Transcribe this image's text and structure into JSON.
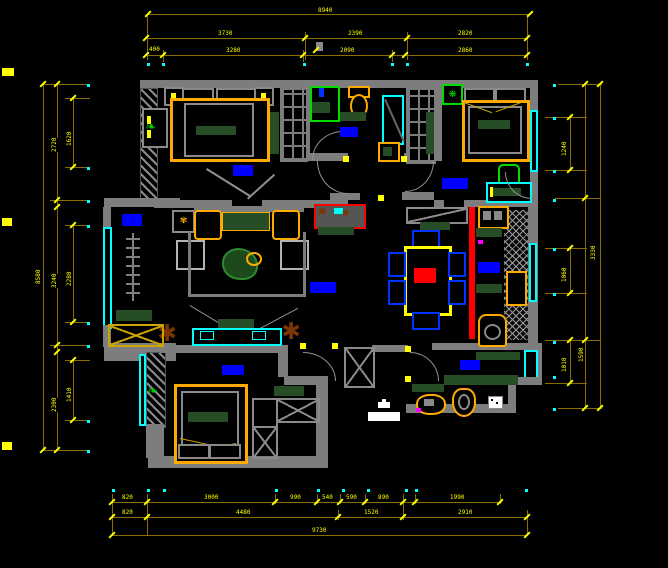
{
  "app": {
    "type": "cad-floor-plan-screenshot",
    "background": "#000000"
  },
  "palette": {
    "wall": "#7d7d7d",
    "dimension_line": "#8a6d00",
    "dimension_text": "#ffff00",
    "window": "#00ffff",
    "room_label_block": "#0000ff",
    "furniture_frame": "#ffaa00",
    "counter_green": "#264d26",
    "fixture_green": "#00dd00",
    "feature_red": "#ff0000",
    "plant_brown": "#7b3503",
    "chair_blue": "#0033ff",
    "white": "#ffffff"
  },
  "dimensions": {
    "lines": [
      {
        "x": 148,
        "y": 14,
        "len": 382,
        "o": "h"
      },
      {
        "x": 146,
        "y": 38,
        "len": 381,
        "o": "h"
      },
      {
        "x": 146,
        "y": 55,
        "len": 381,
        "o": "h"
      },
      {
        "x": 147,
        "y": 14,
        "len": 46,
        "o": "v"
      },
      {
        "x": 527,
        "y": 14,
        "len": 46,
        "o": "v"
      },
      {
        "x": 305,
        "y": 32,
        "len": 28,
        "o": "v"
      },
      {
        "x": 407,
        "y": 32,
        "len": 28,
        "o": "v"
      },
      {
        "x": 163,
        "y": 50,
        "len": 12,
        "o": "v"
      },
      {
        "x": 303,
        "y": 50,
        "len": 12,
        "o": "v"
      },
      {
        "x": 392,
        "y": 50,
        "len": 12,
        "o": "v"
      },
      {
        "x": 112,
        "y": 502,
        "len": 390,
        "o": "h"
      },
      {
        "x": 112,
        "y": 517,
        "len": 415,
        "o": "h"
      },
      {
        "x": 112,
        "y": 535,
        "len": 415,
        "o": "h"
      },
      {
        "x": 112,
        "y": 494,
        "len": 42,
        "o": "v"
      },
      {
        "x": 147,
        "y": 494,
        "len": 42,
        "o": "v"
      },
      {
        "x": 275,
        "y": 494,
        "len": 10,
        "o": "v"
      },
      {
        "x": 317,
        "y": 494,
        "len": 10,
        "o": "v"
      },
      {
        "x": 340,
        "y": 494,
        "len": 10,
        "o": "v"
      },
      {
        "x": 365,
        "y": 494,
        "len": 10,
        "o": "v"
      },
      {
        "x": 403,
        "y": 494,
        "len": 26,
        "o": "v"
      },
      {
        "x": 415,
        "y": 494,
        "len": 10,
        "o": "v"
      },
      {
        "x": 500,
        "y": 494,
        "len": 10,
        "o": "v"
      },
      {
        "x": 527,
        "y": 510,
        "len": 26,
        "o": "v"
      },
      {
        "x": 338,
        "y": 510,
        "len": 10,
        "o": "v"
      },
      {
        "x": 43,
        "y": 84,
        "len": 366,
        "o": "v"
      },
      {
        "x": 57,
        "y": 84,
        "len": 366,
        "o": "v"
      },
      {
        "x": 73,
        "y": 98,
        "len": 69,
        "o": "v"
      },
      {
        "x": 73,
        "y": 225,
        "len": 97,
        "o": "v"
      },
      {
        "x": 73,
        "y": 360,
        "len": 60,
        "o": "v"
      },
      {
        "x": 43,
        "y": 84,
        "len": 47,
        "o": "h"
      },
      {
        "x": 43,
        "y": 450,
        "len": 47,
        "o": "h"
      },
      {
        "x": 65,
        "y": 98,
        "len": 25,
        "o": "h"
      },
      {
        "x": 65,
        "y": 167,
        "len": 25,
        "o": "h"
      },
      {
        "x": 50,
        "y": 200,
        "len": 40,
        "o": "h"
      },
      {
        "x": 65,
        "y": 225,
        "len": 25,
        "o": "h"
      },
      {
        "x": 65,
        "y": 322,
        "len": 25,
        "o": "h"
      },
      {
        "x": 50,
        "y": 345,
        "len": 40,
        "o": "h"
      },
      {
        "x": 65,
        "y": 360,
        "len": 25,
        "o": "h"
      },
      {
        "x": 65,
        "y": 420,
        "len": 25,
        "o": "h"
      },
      {
        "x": 600,
        "y": 84,
        "len": 324,
        "o": "v"
      },
      {
        "x": 585,
        "y": 84,
        "len": 324,
        "o": "v"
      },
      {
        "x": 570,
        "y": 117,
        "len": 53,
        "o": "v"
      },
      {
        "x": 570,
        "y": 248,
        "len": 45,
        "o": "v"
      },
      {
        "x": 570,
        "y": 340,
        "len": 43,
        "o": "v"
      },
      {
        "x": 558,
        "y": 84,
        "len": 44,
        "o": "h"
      },
      {
        "x": 545,
        "y": 117,
        "len": 42,
        "o": "h"
      },
      {
        "x": 545,
        "y": 170,
        "len": 42,
        "o": "h"
      },
      {
        "x": 555,
        "y": 198,
        "len": 46,
        "o": "h"
      },
      {
        "x": 545,
        "y": 248,
        "len": 42,
        "o": "h"
      },
      {
        "x": 545,
        "y": 293,
        "len": 42,
        "o": "h"
      },
      {
        "x": 545,
        "y": 340,
        "len": 56,
        "o": "h"
      },
      {
        "x": 545,
        "y": 383,
        "len": 42,
        "o": "h"
      },
      {
        "x": 558,
        "y": 408,
        "len": 44,
        "o": "h"
      }
    ],
    "ticks": [
      {
        "x": 148,
        "y": 14
      },
      {
        "x": 530,
        "y": 14
      },
      {
        "x": 146,
        "y": 38
      },
      {
        "x": 305,
        "y": 38
      },
      {
        "x": 407,
        "y": 38
      },
      {
        "x": 527,
        "y": 38
      },
      {
        "x": 146,
        "y": 55
      },
      {
        "x": 163,
        "y": 55
      },
      {
        "x": 303,
        "y": 55
      },
      {
        "x": 392,
        "y": 55
      },
      {
        "x": 405,
        "y": 55
      },
      {
        "x": 527,
        "y": 55
      },
      {
        "x": 112,
        "y": 502
      },
      {
        "x": 147,
        "y": 502
      },
      {
        "x": 275,
        "y": 502
      },
      {
        "x": 317,
        "y": 502
      },
      {
        "x": 340,
        "y": 502
      },
      {
        "x": 365,
        "y": 502
      },
      {
        "x": 403,
        "y": 502
      },
      {
        "x": 415,
        "y": 502
      },
      {
        "x": 500,
        "y": 502
      },
      {
        "x": 112,
        "y": 517
      },
      {
        "x": 147,
        "y": 517
      },
      {
        "x": 338,
        "y": 517
      },
      {
        "x": 403,
        "y": 517
      },
      {
        "x": 527,
        "y": 517
      },
      {
        "x": 112,
        "y": 535
      },
      {
        "x": 527,
        "y": 535
      },
      {
        "x": 43,
        "y": 84
      },
      {
        "x": 43,
        "y": 450
      },
      {
        "x": 57,
        "y": 84
      },
      {
        "x": 57,
        "y": 200
      },
      {
        "x": 57,
        "y": 207
      },
      {
        "x": 57,
        "y": 345
      },
      {
        "x": 57,
        "y": 352
      },
      {
        "x": 57,
        "y": 450
      },
      {
        "x": 73,
        "y": 98
      },
      {
        "x": 73,
        "y": 167
      },
      {
        "x": 73,
        "y": 225
      },
      {
        "x": 73,
        "y": 322
      },
      {
        "x": 73,
        "y": 360
      },
      {
        "x": 73,
        "y": 420
      },
      {
        "x": 600,
        "y": 84
      },
      {
        "x": 600,
        "y": 408
      },
      {
        "x": 585,
        "y": 84
      },
      {
        "x": 585,
        "y": 198
      },
      {
        "x": 585,
        "y": 340
      },
      {
        "x": 585,
        "y": 408
      },
      {
        "x": 570,
        "y": 117
      },
      {
        "x": 570,
        "y": 170
      },
      {
        "x": 570,
        "y": 248
      },
      {
        "x": 570,
        "y": 293
      },
      {
        "x": 570,
        "y": 340
      },
      {
        "x": 570,
        "y": 383
      }
    ],
    "labels": [
      {
        "t": "8940",
        "x": 318,
        "y": 8,
        "r": 0
      },
      {
        "t": "3730",
        "x": 218,
        "y": 31,
        "r": 0
      },
      {
        "t": "2390",
        "x": 348,
        "y": 31,
        "r": 0
      },
      {
        "t": "2820",
        "x": 458,
        "y": 31,
        "r": 0
      },
      {
        "t": "400",
        "x": 149,
        "y": 47,
        "r": 0
      },
      {
        "t": "3280",
        "x": 226,
        "y": 48,
        "r": 0
      },
      {
        "t": "2090",
        "x": 340,
        "y": 48,
        "r": 0
      },
      {
        "t": "2860",
        "x": 458,
        "y": 48,
        "r": 0
      },
      {
        "t": "820",
        "x": 122,
        "y": 495,
        "r": 0
      },
      {
        "t": "3000",
        "x": 204,
        "y": 495,
        "r": 0
      },
      {
        "t": "990",
        "x": 290,
        "y": 495,
        "r": 0
      },
      {
        "t": "540",
        "x": 322,
        "y": 495,
        "r": 0
      },
      {
        "t": "590",
        "x": 346,
        "y": 495,
        "r": 0
      },
      {
        "t": "890",
        "x": 378,
        "y": 495,
        "r": 0
      },
      {
        "t": "1990",
        "x": 450,
        "y": 495,
        "r": 0
      },
      {
        "t": "820",
        "x": 122,
        "y": 510,
        "r": 0
      },
      {
        "t": "4480",
        "x": 236,
        "y": 510,
        "r": 0
      },
      {
        "t": "1520",
        "x": 364,
        "y": 510,
        "r": 0
      },
      {
        "t": "2910",
        "x": 458,
        "y": 510,
        "r": 0
      },
      {
        "t": "9730",
        "x": 312,
        "y": 528,
        "r": 0
      },
      {
        "t": "2720",
        "x": 52,
        "y": 152,
        "r": 90
      },
      {
        "t": "3240",
        "x": 52,
        "y": 288,
        "r": 90
      },
      {
        "t": "2300",
        "x": 52,
        "y": 412,
        "r": 90
      },
      {
        "t": "1620",
        "x": 67,
        "y": 146,
        "r": 90
      },
      {
        "t": "2280",
        "x": 67,
        "y": 286,
        "r": 90
      },
      {
        "t": "1410",
        "x": 67,
        "y": 402,
        "r": 90
      },
      {
        "t": "8580",
        "x": 36,
        "y": 284,
        "r": 90
      },
      {
        "t": "1240",
        "x": 562,
        "y": 156,
        "r": 90
      },
      {
        "t": "1060",
        "x": 562,
        "y": 282,
        "r": 90
      },
      {
        "t": "1010",
        "x": 562,
        "y": 372,
        "r": 90
      },
      {
        "t": "3330",
        "x": 591,
        "y": 260,
        "r": 90
      },
      {
        "t": "1590",
        "x": 579,
        "y": 362,
        "r": 90
      }
    ],
    "dots": [
      {
        "x": 147,
        "y": 63
      },
      {
        "x": 162,
        "y": 63
      },
      {
        "x": 303,
        "y": 63
      },
      {
        "x": 391,
        "y": 63
      },
      {
        "x": 406,
        "y": 63
      },
      {
        "x": 526,
        "y": 63
      },
      {
        "x": 112,
        "y": 489
      },
      {
        "x": 147,
        "y": 489
      },
      {
        "x": 163,
        "y": 489
      },
      {
        "x": 275,
        "y": 489
      },
      {
        "x": 317,
        "y": 489
      },
      {
        "x": 342,
        "y": 489
      },
      {
        "x": 367,
        "y": 489
      },
      {
        "x": 405,
        "y": 489
      },
      {
        "x": 415,
        "y": 489
      },
      {
        "x": 525,
        "y": 489
      },
      {
        "x": 87,
        "y": 84
      },
      {
        "x": 87,
        "y": 167
      },
      {
        "x": 87,
        "y": 200
      },
      {
        "x": 87,
        "y": 225
      },
      {
        "x": 87,
        "y": 322
      },
      {
        "x": 87,
        "y": 345
      },
      {
        "x": 87,
        "y": 420
      },
      {
        "x": 87,
        "y": 450
      },
      {
        "x": 553,
        "y": 84
      },
      {
        "x": 553,
        "y": 117
      },
      {
        "x": 553,
        "y": 170
      },
      {
        "x": 553,
        "y": 199
      },
      {
        "x": 553,
        "y": 248
      },
      {
        "x": 553,
        "y": 293
      },
      {
        "x": 553,
        "y": 341
      },
      {
        "x": 553,
        "y": 376
      },
      {
        "x": 553,
        "y": 408
      }
    ],
    "edge_marks": [
      {
        "x": 2,
        "y": 68,
        "w": 12,
        "h": 8
      },
      {
        "x": 2,
        "y": 218,
        "w": 10,
        "h": 8
      },
      {
        "x": 2,
        "y": 442,
        "w": 10,
        "h": 8
      }
    ]
  },
  "room_labels": [
    {
      "x": 233,
      "y": 165,
      "w": 20,
      "h": 11
    },
    {
      "x": 340,
      "y": 127,
      "w": 18,
      "h": 10
    },
    {
      "x": 442,
      "y": 178,
      "w": 26,
      "h": 11
    },
    {
      "x": 122,
      "y": 214,
      "w": 20,
      "h": 12
    },
    {
      "x": 310,
      "y": 282,
      "w": 26,
      "h": 11
    },
    {
      "x": 478,
      "y": 262,
      "w": 22,
      "h": 11
    },
    {
      "x": 222,
      "y": 365,
      "w": 22,
      "h": 10
    },
    {
      "x": 460,
      "y": 360,
      "w": 20,
      "h": 10
    }
  ]
}
